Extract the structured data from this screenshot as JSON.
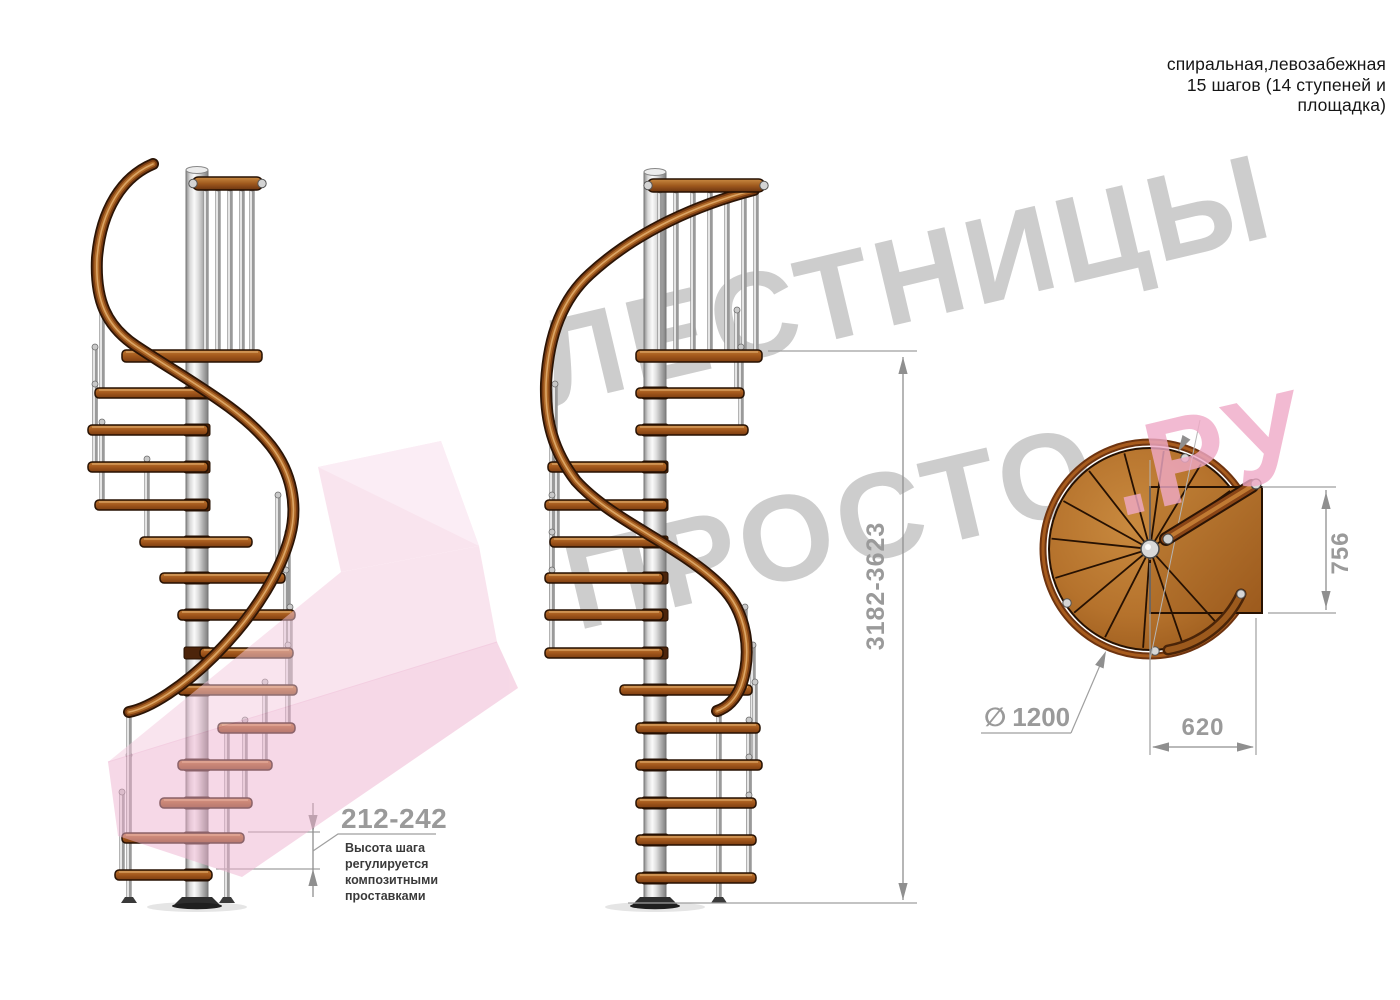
{
  "title": {
    "lines": [
      "спиральная,левозабежная",
      "15 шагов (14 ступеней и",
      "площадка)"
    ]
  },
  "watermark": {
    "word_top": "ЛЕСТНИЦЫ",
    "word_bottom": "ПРОСТО",
    "word_suffix": ".РУ"
  },
  "elevation_dimensions": {
    "total_height": "3182-3623",
    "step_height": "212-242",
    "step_height_note": [
      "Высота шага",
      "регулируется",
      "композитными",
      "проставками"
    ]
  },
  "plan_dimensions": {
    "diameter_symbol": "∅",
    "diameter": "1200",
    "platform_depth": "756",
    "platform_width": "620"
  },
  "colors": {
    "dimension_text": "#9a9a9a",
    "note_text": "#3a3a3a",
    "wood_dark": "#7c3d12",
    "wood_mid": "#b06a28",
    "wood_light": "#dca566",
    "metal": "#c9c9c9",
    "watermark_gray": "#c5c5c5",
    "watermark_pink": "#f0aac7",
    "arrow_pink": "#f5cadf"
  }
}
